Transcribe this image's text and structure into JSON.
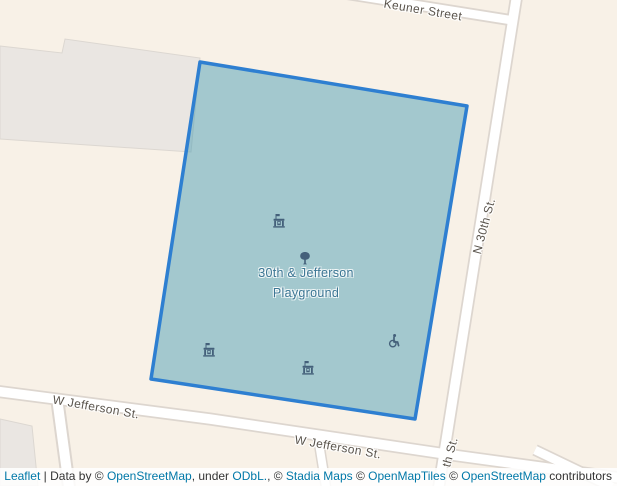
{
  "colors": {
    "map_background": "#f8f1e7",
    "building_fill": "#eae6e2",
    "building_border": "#dcd7d1",
    "road_fill": "#ffffff",
    "road_casing": "#ddd6cf",
    "street_label": "#5a544c",
    "polygon_stroke": "#2e7fd1",
    "polygon_fill": "rgba(60,150,175,0.45)",
    "polygon_surface": "#a3c8ce",
    "poi_label": "#3b7593",
    "poi_icon": "#44607a",
    "attribution_text": "#333333",
    "attribution_link": "#0078a8"
  },
  "streets": {
    "keuner": {
      "label": "Keuner Street"
    },
    "n_30th": {
      "label": "N 30th St."
    },
    "n_30th_partial": {
      "label": "th St."
    },
    "w_jefferson_west": {
      "label": "W Jefferson St."
    },
    "w_jefferson_east": {
      "label": "W Jefferson St."
    }
  },
  "poi": {
    "playground": {
      "line1": "30th & Jefferson",
      "line2": "Playground",
      "icons": [
        {
          "name": "playground-icon"
        },
        {
          "name": "tree-icon"
        },
        {
          "name": "playground-icon"
        },
        {
          "name": "playground-icon"
        },
        {
          "name": "wheelchair-icon"
        }
      ]
    }
  },
  "attribution": {
    "parts": [
      {
        "text": "Leaflet",
        "link": true
      },
      {
        "text": " | Data by © ",
        "link": false
      },
      {
        "text": "OpenStreetMap",
        "link": true
      },
      {
        "text": ", under ",
        "link": false
      },
      {
        "text": "ODbL.",
        "link": true
      },
      {
        "text": ", © ",
        "link": false
      },
      {
        "text": "Stadia Maps",
        "link": true
      },
      {
        "text": " © ",
        "link": false
      },
      {
        "text": "OpenMapTiles",
        "link": true
      },
      {
        "text": " © ",
        "link": false
      },
      {
        "text": "OpenStreetMap",
        "link": true
      },
      {
        "text": " contributors",
        "link": false
      }
    ]
  }
}
